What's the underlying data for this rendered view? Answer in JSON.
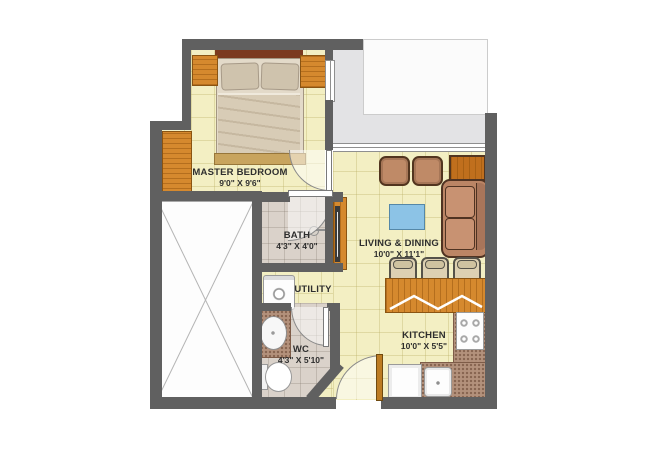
{
  "plan_title": "1 BHK apartment floor plan",
  "rooms": [
    {
      "name": "MASTER BEDROOM",
      "dim": "9'0\" X 9'6\""
    },
    {
      "name": "BATH",
      "dim": "4'3\" X 4'0\""
    },
    {
      "name": "UTILITY",
      "dim": ""
    },
    {
      "name": "WC",
      "dim": "4'3\" X 5'10\""
    },
    {
      "name": "LIVING & DINING",
      "dim": "10'0\" X 11'1\""
    },
    {
      "name": "KITCHEN",
      "dim": "10'0\" X 5'5\""
    }
  ],
  "colors": {
    "wall": "#606060",
    "floor_tile": "#f3efc3",
    "wet_floor": "#dad2ca",
    "balcony": "#e3e3e5",
    "wood": "#d5892e",
    "sofa": "#bf8a67",
    "coffee_table": "#8cc3e6",
    "granite": "#b3917c",
    "headboard": "#7b3a1f",
    "label_text": "#2e2e2e"
  },
  "furniture": [
    "double-bed",
    "wardrobe",
    "nightstand",
    "tv-unit",
    "sofa",
    "pouf",
    "coffee-table",
    "side-table",
    "breakfast-counter",
    "bar-stool",
    "hob",
    "kitchen-sink",
    "refrigerator",
    "washing-machine",
    "washbasin",
    "toilet",
    "shower",
    "void-shaft"
  ]
}
